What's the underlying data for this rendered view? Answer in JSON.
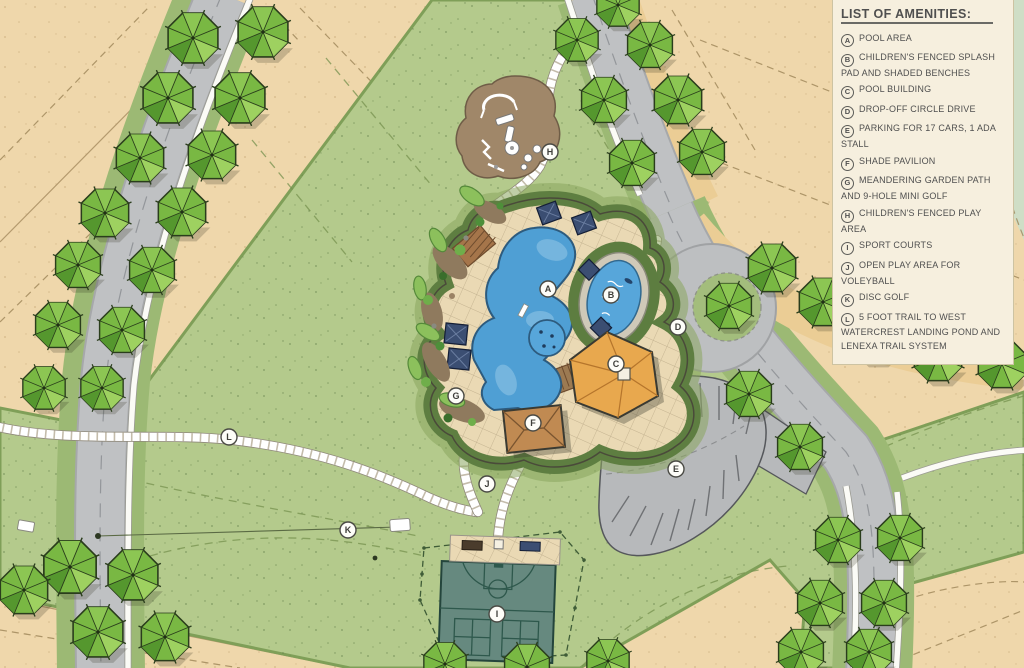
{
  "legend": {
    "title": "LIST OF AMENITIES:",
    "items": [
      {
        "letter": "A",
        "label": "POOL AREA"
      },
      {
        "letter": "B",
        "label": "CHILDREN'S FENCED SPLASH PAD AND SHADED BENCHES"
      },
      {
        "letter": "C",
        "label": "POOL BUILDING"
      },
      {
        "letter": "D",
        "label": "DROP-OFF CIRCLE DRIVE"
      },
      {
        "letter": "E",
        "label": "PARKING FOR 17 CARS, 1 ADA STALL"
      },
      {
        "letter": "F",
        "label": "SHADE PAVILION"
      },
      {
        "letter": "G",
        "label": "MEANDERING GARDEN PATH AND 9-HOLE MINI GOLF"
      },
      {
        "letter": "H",
        "label": "CHILDREN'S FENCED PLAY AREA"
      },
      {
        "letter": "I",
        "label": "SPORT COURTS"
      },
      {
        "letter": "J",
        "label": "OPEN PLAY AREA FOR VOLEYBALL"
      },
      {
        "letter": "K",
        "label": "DISC GOLF"
      },
      {
        "letter": "L",
        "label": "5 FOOT TRAIL TO WEST WATERCREST LANDING POND AND LENEXA TRAIL SYSTEM"
      }
    ]
  },
  "colors": {
    "lot_tan": "#efd7ab",
    "park_green": "#b4ca8c",
    "deck_tan": "#ead9b4",
    "road_gray": "#bfc1c3",
    "path_white": "#ffffff",
    "pool_blue": "#4f9fd4",
    "splash_blue": "#57a6da",
    "roof_orange": "#e8a84e",
    "pavilion_brown": "#c08a52",
    "cabana_navy": "#3b4e72",
    "court_teal": "#66897f",
    "tree_green": "#79b843",
    "legend_bg": "#f6efde",
    "text_gray": "#4f4f4f"
  }
}
